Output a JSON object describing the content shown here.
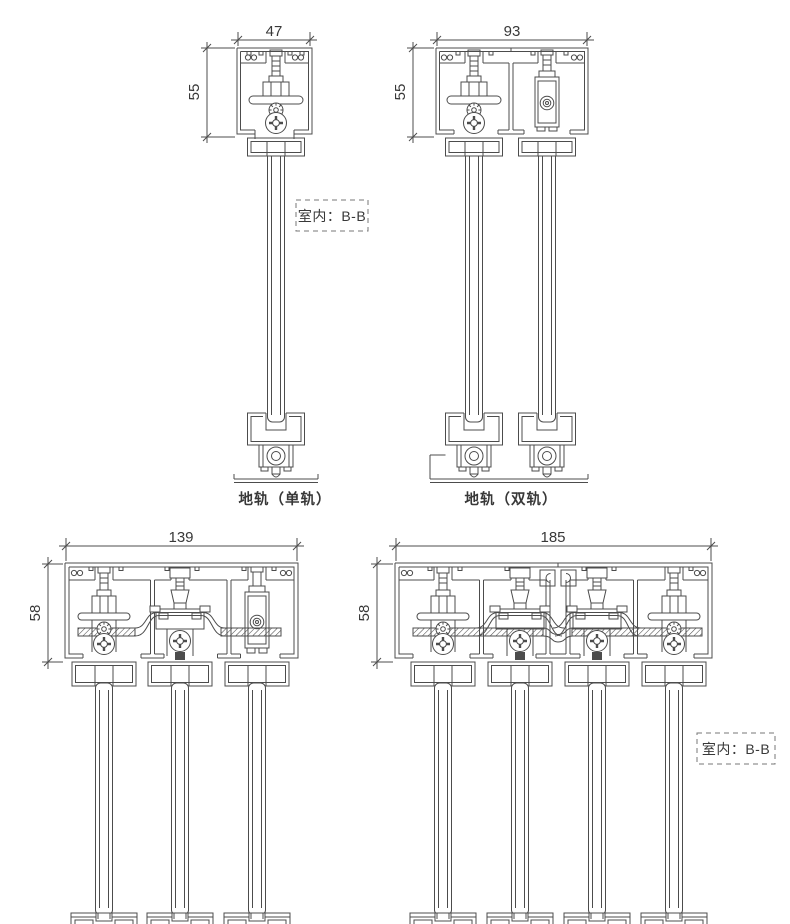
{
  "sheet": {
    "type": "technical-cross-section-drawing",
    "background": "#ffffff",
    "line_color": "#4c4c4c",
    "text_color": "#383838",
    "dash_box_color": "#777777"
  },
  "drawings": {
    "top_single": {
      "width_dim": "47",
      "height_dim": "55",
      "caption": "地轨（单轨）",
      "room_label": "室内：B-B"
    },
    "top_double": {
      "width_dim": "93",
      "height_dim": "55",
      "caption": "地轨（双轨）"
    },
    "bottom_triple": {
      "width_dim": "139",
      "height_dim": "58"
    },
    "bottom_quad": {
      "width_dim": "185",
      "height_dim": "58",
      "room_label": "室内：B-B"
    }
  }
}
